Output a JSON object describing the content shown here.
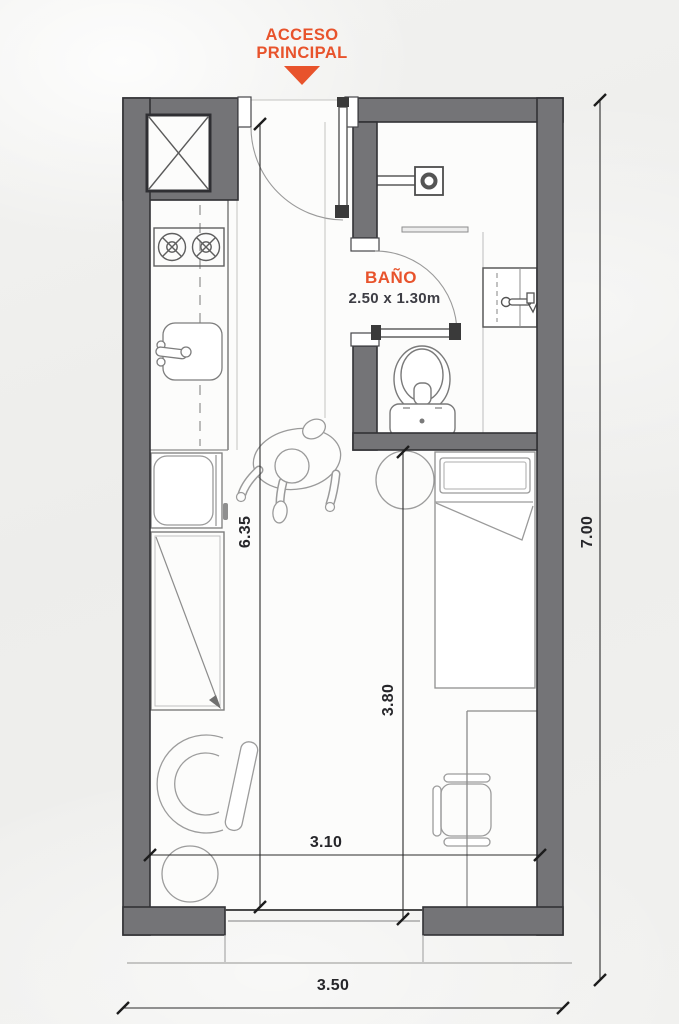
{
  "access": {
    "line1": "ACCESO",
    "line2": "PRINCIPAL"
  },
  "bathroom": {
    "name": "BAÑO",
    "size": "2.50 x 1.30m"
  },
  "dimensions": {
    "interior_length": "6.35",
    "bedroom_depth": "3.80",
    "interior_width": "3.10",
    "overall_depth": "7.00",
    "overall_width": "3.50"
  },
  "colors": {
    "accent": "#E8532C",
    "wall_fill": "#747477",
    "wall_edge": "#323236",
    "dimension_text": "#26262A",
    "bathroom_size_text": "#3D3D44"
  }
}
